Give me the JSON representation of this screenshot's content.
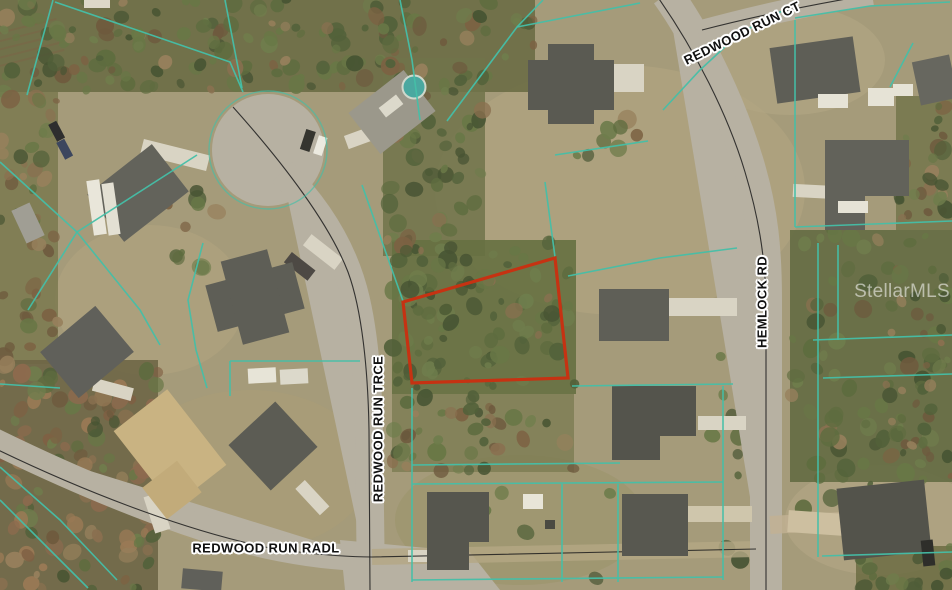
{
  "map": {
    "street_labels": [
      {
        "id": "redwood-run-ct",
        "text": "REDWOOD RUN CT"
      },
      {
        "id": "redwood-run-trce",
        "text": "REDWOOD RUN TRCE"
      },
      {
        "id": "hemlock-rd",
        "text": "HEMLOCK RD"
      },
      {
        "id": "redwood-run-radl",
        "text": "REDWOOD RUN RADL"
      }
    ],
    "watermark": "StellarMLS",
    "colors": {
      "parcel_line": "#44bfa8",
      "subject_parcel_outline": "#c63212",
      "road_centerline": "#1c1c1c",
      "label_text": "#111111",
      "label_halo": "#ffffff",
      "watermark_color": "rgba(255,255,255,0.55)"
    }
  }
}
